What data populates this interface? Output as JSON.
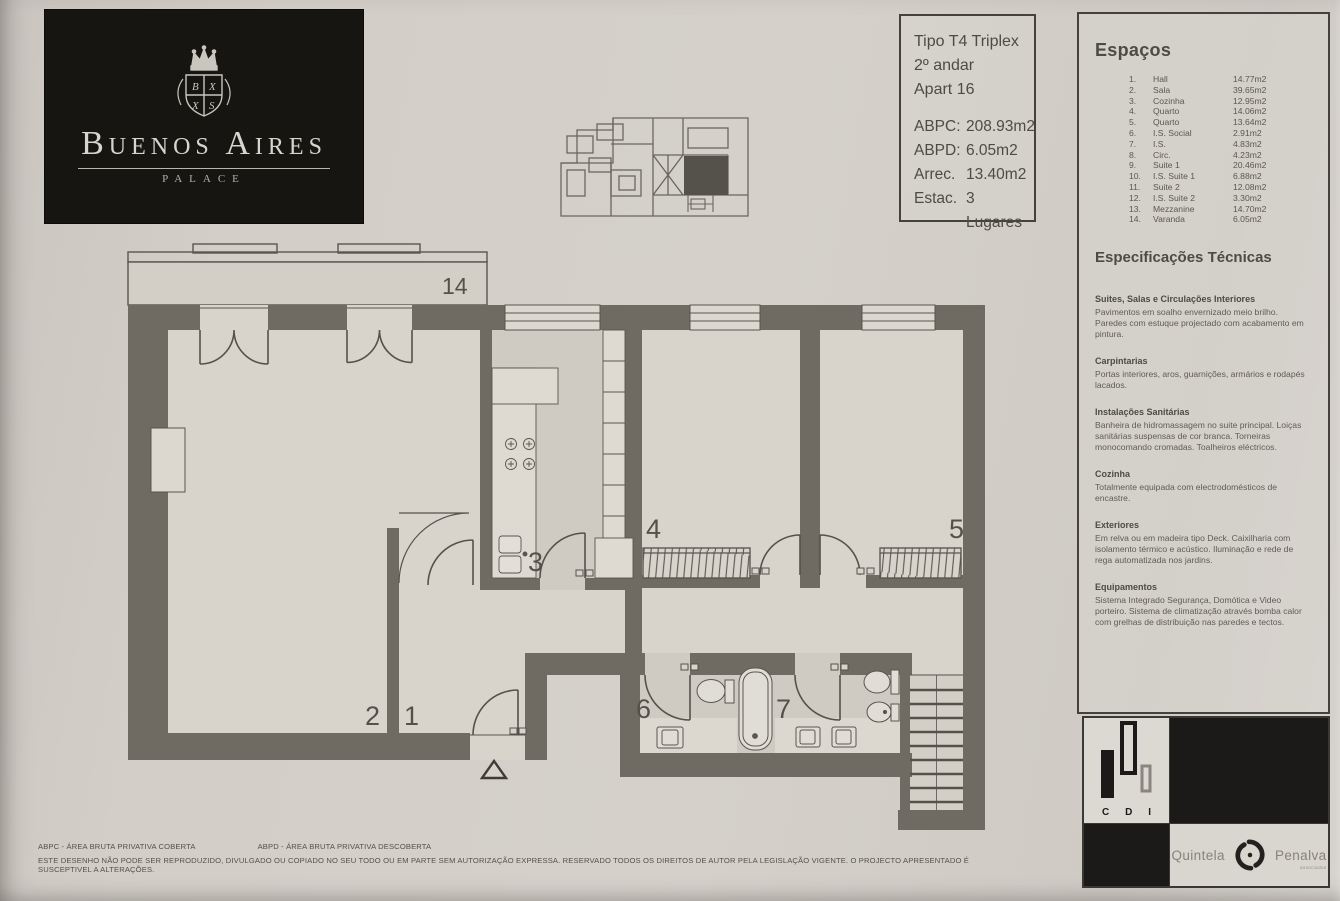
{
  "colors": {
    "paper": "#d2cdc7",
    "wall": "#6f6b62",
    "ink": "#55514a",
    "logo_bg": "#171512",
    "floor": "#d8d4cc",
    "floor_dark": "#cfcbc3"
  },
  "logo": {
    "name": "Buenos Aires",
    "subtitle": "PALACE"
  },
  "info_box": {
    "line1": "Tipo T4 Triplex",
    "line2": "2º andar",
    "line3": "Apart 16",
    "areas": [
      {
        "label": "ABPC:",
        "value": "208.93m2"
      },
      {
        "label": "ABPD:",
        "value": "6.05m2"
      },
      {
        "label": "Arrec.",
        "value": "13.40m2"
      },
      {
        "label": "Estac.",
        "value": "3 Lugares"
      }
    ]
  },
  "espacos": {
    "title": "Espaços",
    "items": [
      {
        "num": "1.",
        "name": "Hall",
        "area": "14.77m2"
      },
      {
        "num": "2.",
        "name": "Sala",
        "area": "39.65m2"
      },
      {
        "num": "3.",
        "name": "Cozinha",
        "area": "12.95m2"
      },
      {
        "num": "4.",
        "name": "Quarto",
        "area": "14.06m2"
      },
      {
        "num": "5.",
        "name": "Quarto",
        "area": "13.64m2"
      },
      {
        "num": "6.",
        "name": "I.S. Social",
        "area": "2.91m2"
      },
      {
        "num": "7.",
        "name": "I.S.",
        "area": "4.83m2"
      },
      {
        "num": "8.",
        "name": "Circ.",
        "area": "4.23m2"
      },
      {
        "num": "9.",
        "name": "Suite 1",
        "area": "20.46m2"
      },
      {
        "num": "10.",
        "name": "I.S. Suite 1",
        "area": "6.88m2"
      },
      {
        "num": "11.",
        "name": "Suite 2",
        "area": "12.08m2"
      },
      {
        "num": "12.",
        "name": "I.S. Suite 2",
        "area": "3.30m2"
      },
      {
        "num": "13.",
        "name": "Mezzanine",
        "area": "14.70m2"
      },
      {
        "num": "14.",
        "name": "Varanda",
        "area": "6.05m2"
      }
    ]
  },
  "specs": {
    "title": "Especificações Técnicas",
    "sections": [
      {
        "heading": "Suites, Salas e Circulações Interiores",
        "body": "Pavimentos em soalho envernizado meio brilho. Paredes com estuque projectado com acabamento em pintura."
      },
      {
        "heading": "Carpintarias",
        "body": "Portas interiores, aros, guarnições, armários e rodapés lacados."
      },
      {
        "heading": "Instalações Sanitárias",
        "body": "Banheira de hidromassagem no suite principal. Loiças sanitárias suspensas de cor branca. Torneiras monocomando cromadas. Toalheiros eléctricos."
      },
      {
        "heading": "Cozinha",
        "body": "Totalmente equipada com electrodomésticos de encastre."
      },
      {
        "heading": "Exteriores",
        "body": "Em relva ou em madeira tipo Deck. Caixilharia com isolamento térmico e acústico. Iluminação e rede de rega automatizada nos jardins."
      },
      {
        "heading": "Equipamentos",
        "body": "Sistema Integrado Segurança, Domótica e Video porteiro. Sistema de climatização através bomba calor com grelhas de distribuição nas paredes e tectos."
      }
    ]
  },
  "plan": {
    "room_numbers": {
      "hall": "1",
      "sala": "2",
      "cozinha": "3",
      "quarto_4": "4",
      "quarto_5": "5",
      "is_social": "6",
      "is_7": "7",
      "varanda": "14"
    }
  },
  "branding": {
    "cdi": {
      "c": "C",
      "d": "D",
      "i": "I"
    },
    "agency": {
      "name_left": "Quintela",
      "name_right": "Penalva",
      "subtitle": "associados"
    }
  },
  "footer": {
    "abbr_1": "ABPC - ÁREA BRUTA PRIVATIVA COBERTA",
    "abbr_2": "ABPD - ÁREA BRUTA PRIVATIVA DESCOBERTA",
    "disclaimer": "ESTE DESENHO NÃO PODE SER REPRODUZIDO, DIVULGADO OU COPIADO NO SEU TODO OU EM PARTE SEM AUTORIZAÇÃO EXPRESSA. RESERVADO TODOS OS DIREITOS DE AUTOR PELA LEGISLAÇÃO VIGENTE. O PROJECTO APRESENTADO É SUSCEPTIVEL A ALTERAÇÕES."
  }
}
